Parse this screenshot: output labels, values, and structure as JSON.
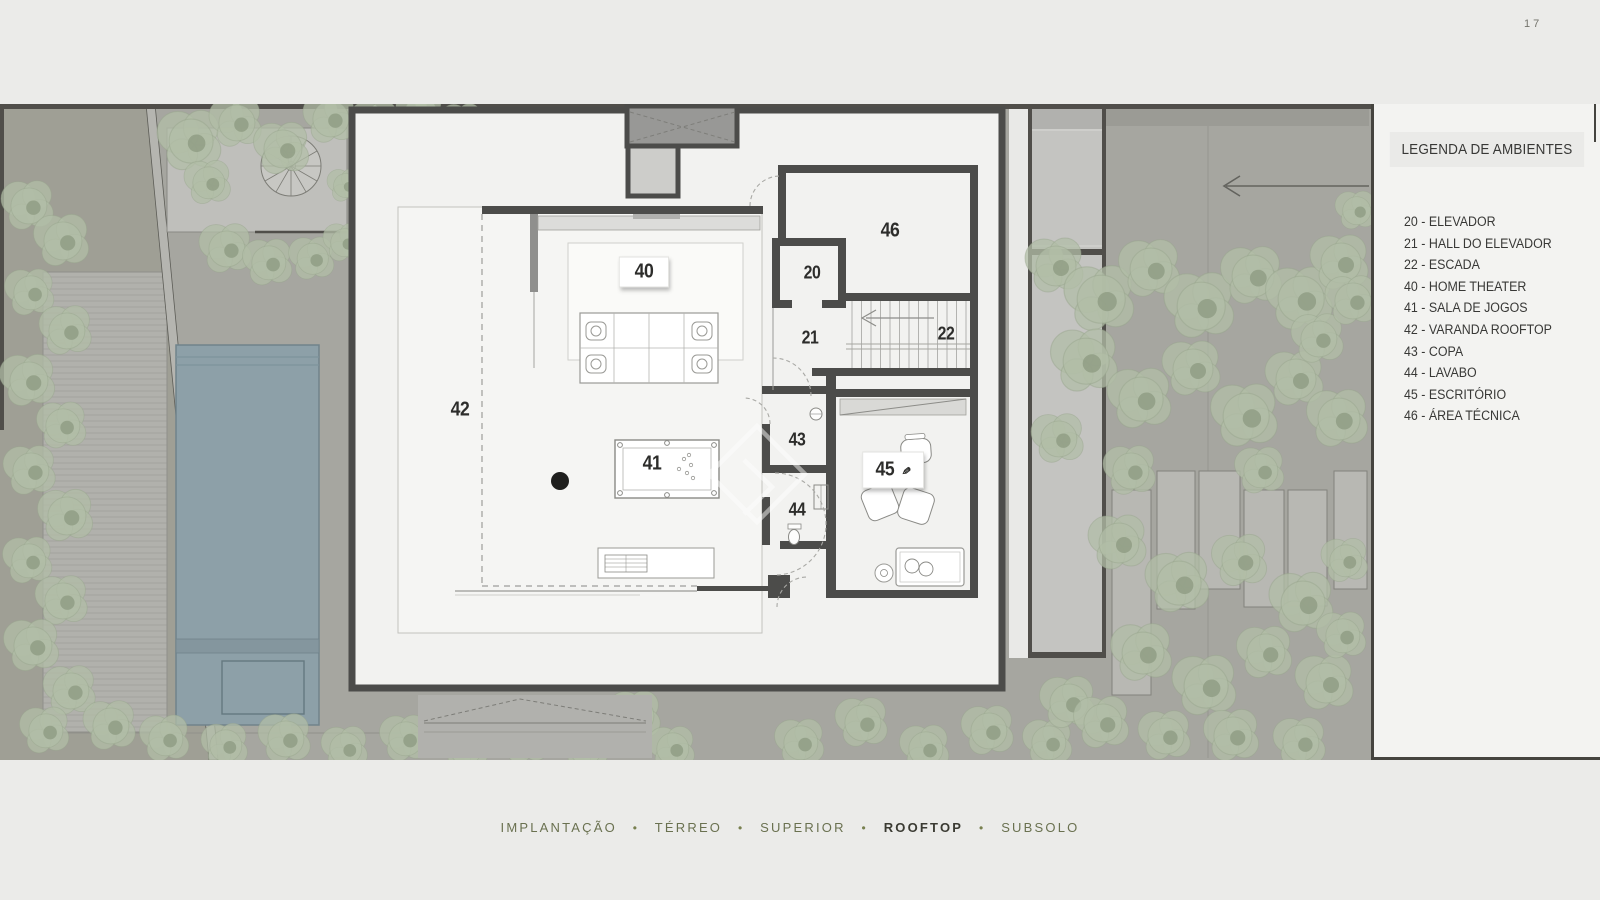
{
  "page": {
    "number": "17"
  },
  "legend": {
    "title": "LEGENDA DE AMBIENTES",
    "items": [
      "20 - ELEVADOR",
      "21 - HALL DO ELEVADOR",
      "22 - ESCADA",
      "40 - HOME THEATER",
      "41 - SALA DE JOGOS",
      "42 - VARANDA ROOFTOP",
      "43 - COPA",
      "44 - LAVABO",
      "45 - ESCRITÓRIO",
      "46 - ÁREA TÉCNICA"
    ]
  },
  "nav": {
    "separator": "•",
    "items": [
      "IMPLANTAÇÃO",
      "TÉRREO",
      "SUPERIOR",
      "ROOFTOP",
      "SUBSOLO"
    ],
    "active": "ROOFTOP"
  },
  "plan": {
    "rooms": {
      "r20": "20",
      "r21": "21",
      "r22": "22",
      "r40": "40",
      "r41": "41",
      "r42": "42",
      "r43": "43",
      "r44": "44",
      "r45": "45",
      "r46": "46"
    }
  },
  "icons": {
    "pen": "✎"
  },
  "colors": {
    "wall": "#4c4c4a",
    "ground": "#a6a6a0",
    "veg": "#b2bda7",
    "pool": "#8da0a8",
    "panel": "#f3f3f1",
    "accent": "#6a7150",
    "text": "#383836",
    "page": "#ebebe9"
  }
}
